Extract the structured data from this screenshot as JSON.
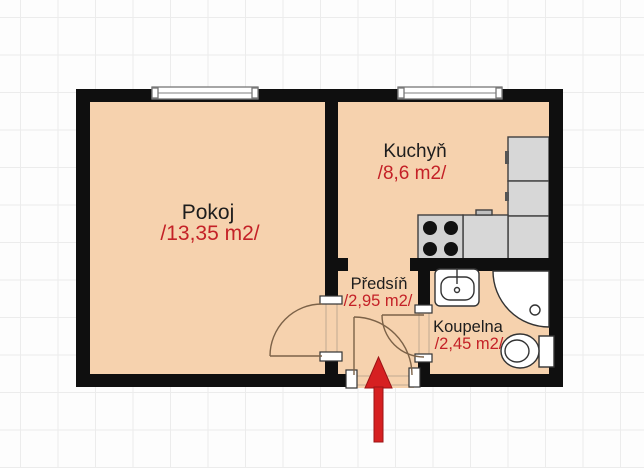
{
  "plan": {
    "type": "apartment-floorplan",
    "rooms": [
      {
        "name": "Pokoj",
        "area": "/13,35 m2/"
      },
      {
        "name": "Kuchyň",
        "area": "/8,6 m2/"
      },
      {
        "name": "Předsíň",
        "area": "/2,95 m2/"
      },
      {
        "name": "Koupelna",
        "area": "/2,45 m2/"
      }
    ],
    "fixtures": [
      "window-pokoj",
      "window-kuchyn",
      "stove-4-burners",
      "kitchen-counter",
      "kitchen-cabinet-upper",
      "kitchen-cabinet-lower",
      "washbasin",
      "corner-shower",
      "toilet"
    ],
    "doors": [
      "door-pokoj-predsin",
      "door-koupelna",
      "entrance-door"
    ],
    "entrance_marker": "red-arrow-pointing-to-entrance",
    "colors": {
      "floor_fill": "#f6d2ae",
      "wall": "#0f0f0f",
      "room_label": "#1d1d1d",
      "area_label": "#c42127",
      "fixture_gray": "#d7d7d7",
      "arrow_red": "#d62021",
      "grid_line": "#ececec"
    }
  }
}
